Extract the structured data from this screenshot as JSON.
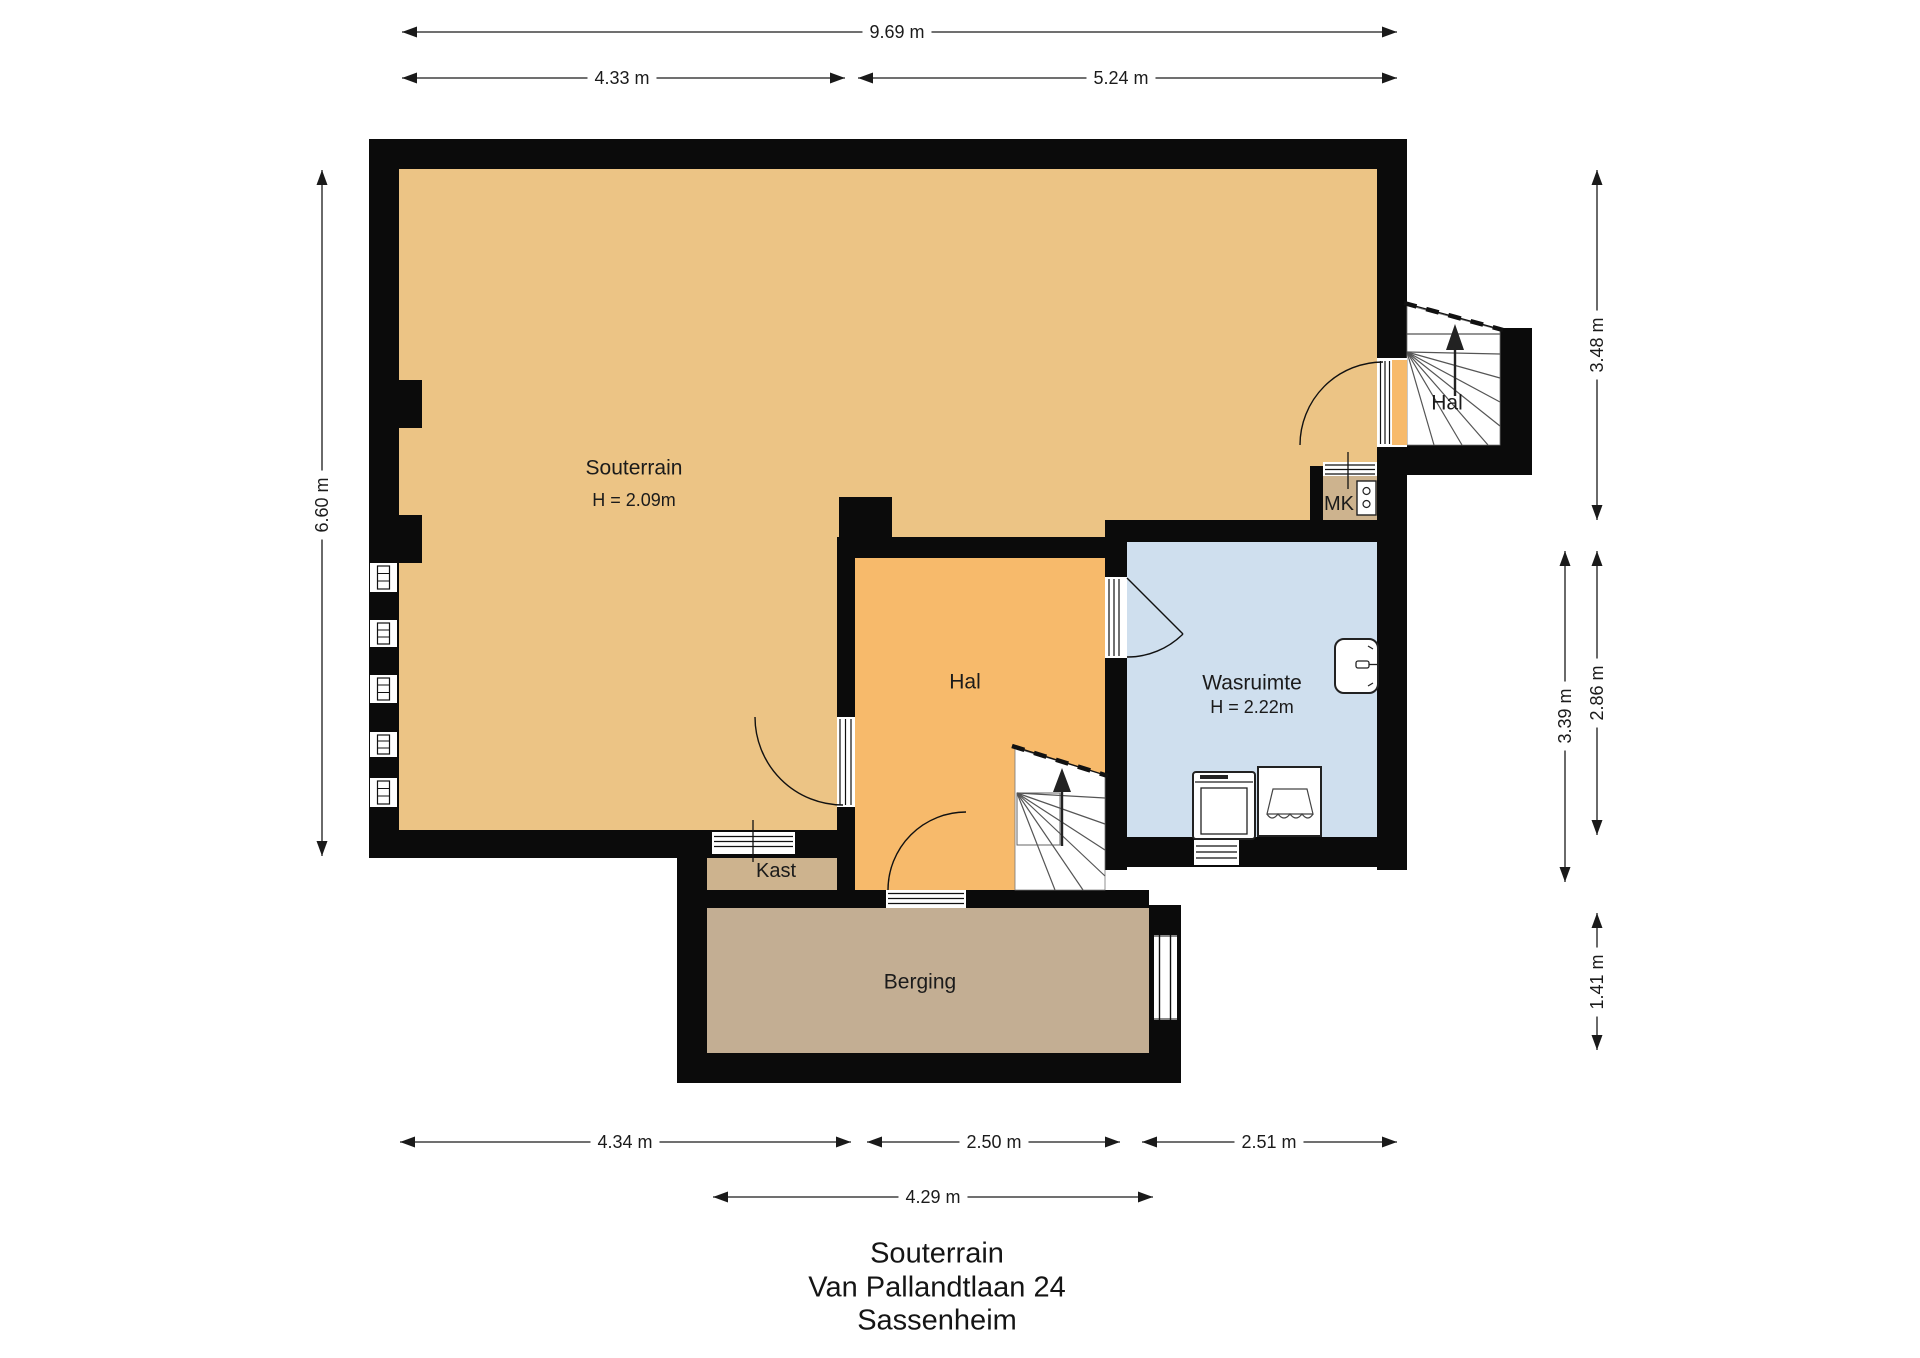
{
  "title": {
    "line1": "Souterrain",
    "line2": "Van Pallandtlaan 24",
    "line3": "Sassenheim"
  },
  "rooms": {
    "souterrain": {
      "label": "Souterrain",
      "height": "H = 2.09m"
    },
    "hal_top": {
      "label": "Hal"
    },
    "mk": {
      "label": "MK"
    },
    "hal": {
      "label": "Hal"
    },
    "wasruimte": {
      "label": "Wasruimte",
      "height": "H = 2.22m"
    },
    "kast": {
      "label": "Kast"
    },
    "berging": {
      "label": "Berging"
    }
  },
  "dimensions": {
    "top_total": "9.69 m",
    "top_left": "4.33 m",
    "top_right": "5.24 m",
    "left_height": "6.60 m",
    "right_upper": "3.48 m",
    "right_middle": "2.86 m",
    "right_inner": "3.39 m",
    "right_lower": "1.41 m",
    "bottom_left": "4.34 m",
    "bottom_middle": "2.50 m",
    "bottom_right": "2.51 m",
    "bottom_inner": "4.29 m"
  },
  "icons": {
    "stairs_up_arrow": "▲ direction-of-climb arrow on winder stairs",
    "door_swing": "quarter-circle swing arc",
    "window": "double-line window symbol",
    "sink": "rounded basin with tap",
    "washing_machine": "square appliance with inner door",
    "laundry_basket": "box with cloth flap",
    "meter_panel": "meterkast panel with two dials"
  },
  "colors": {
    "wall": "#0b0b0b",
    "souterrain_floor": "#ecc485",
    "hal_floor": "#f7ba6b",
    "wasruimte_floor": "#cfdfee",
    "kast_floor": "#cdb38e",
    "berging_floor": "#c3ae93",
    "dimension_line": "#1a1a1a",
    "background": "#ffffff"
  }
}
